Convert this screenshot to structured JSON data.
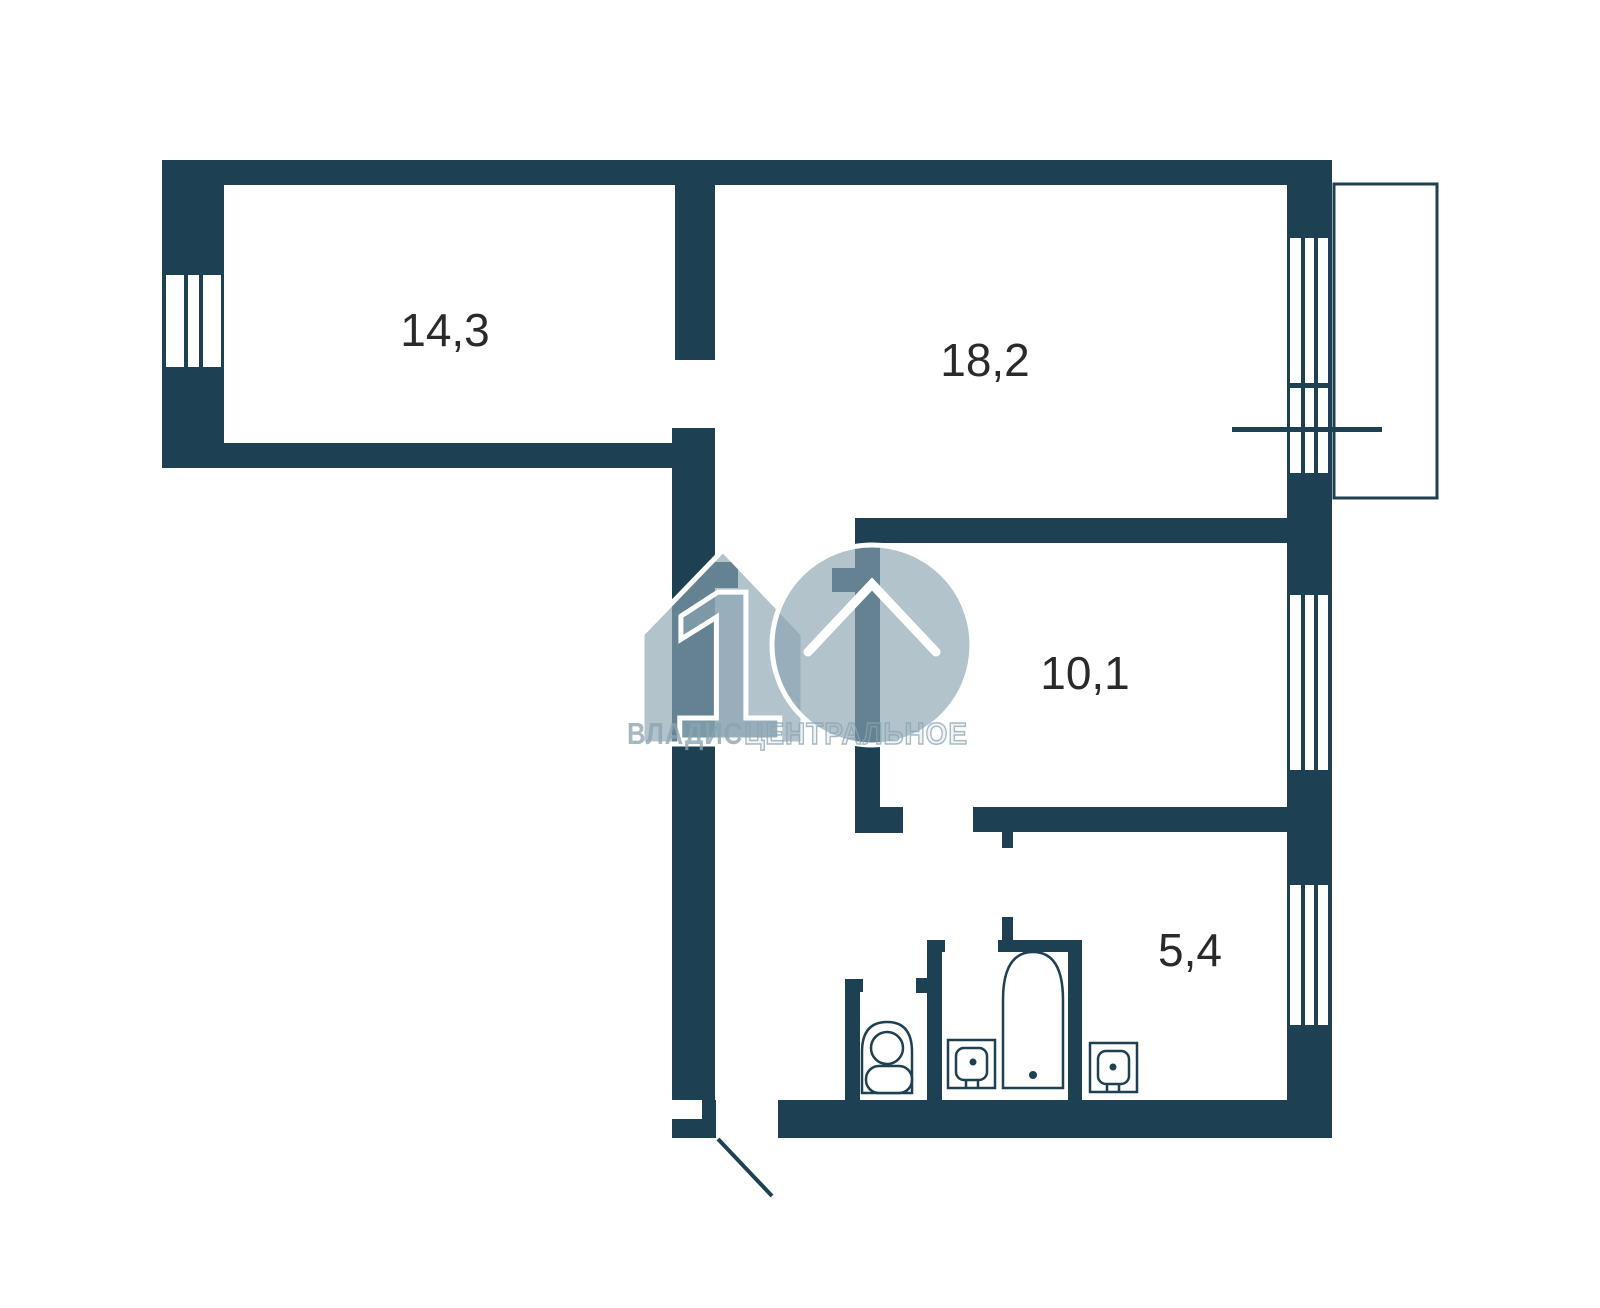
{
  "floor_plan": {
    "type": "apartment-floor-plan",
    "rooms": [
      {
        "name": "room-1",
        "area_label": "14,3"
      },
      {
        "name": "living-room",
        "area_label": "18,2"
      },
      {
        "name": "room-2",
        "area_label": "10,1"
      },
      {
        "name": "kitchen",
        "area_label": "5,4"
      }
    ],
    "fixtures": [
      "toilet-icon",
      "bathroom-sink-icon",
      "bathtub-icon",
      "kitchen-sink-icon"
    ],
    "features": [
      "balcony",
      "entry-door",
      "window-left",
      "window-living-room",
      "window-room-2",
      "window-kitchen"
    ],
    "watermark": {
      "logo_number": "1",
      "brand": "ВЛАДИС",
      "branch": "ЦЕНТРАЛЬНОЕ"
    },
    "colors": {
      "wall": "#1d4153",
      "background": "#ffffff",
      "watermark": "#8aa4b1",
      "label_text": "#2a2a2a"
    }
  }
}
